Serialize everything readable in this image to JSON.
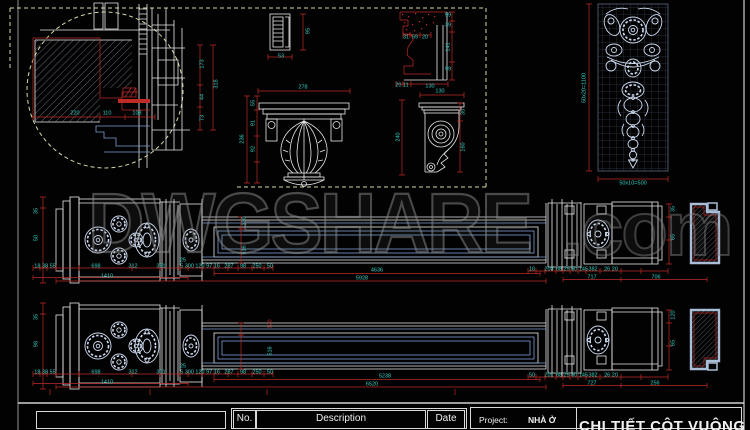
{
  "watermark": {
    "text": "DWGSHARE",
    "suffix": ".com"
  },
  "title_block": {
    "no": "No.",
    "description": "Description",
    "date": "Date",
    "project_label": "Project:",
    "project_value": "NHÀ Ở",
    "drawing_title": "CHI TIẾT CỘT VUÔNG"
  },
  "colors": {
    "background": "#020202",
    "line": "#e8e8e8",
    "blue": "#7d9fd4",
    "ornament": "#cfdcf2",
    "dim_line": "#bf2b26",
    "dim_text": "#35cfc4",
    "dashed": "#d8d8a8",
    "grid": "#46536a",
    "section": "#a9bdd6",
    "frame": "#cfcfcf"
  },
  "annotations": [
    {
      "t": "220",
      "x": 75,
      "y": 114
    },
    {
      "t": "110",
      "x": 107,
      "y": 114
    },
    {
      "t": "108",
      "x": 137,
      "y": 114
    },
    {
      "t": "173",
      "x": 203,
      "y": 64,
      "r": -90
    },
    {
      "t": "318",
      "x": 217,
      "y": 84,
      "r": -90
    },
    {
      "t": "44",
      "x": 203,
      "y": 97,
      "r": -90
    },
    {
      "t": "73",
      "x": 203,
      "y": 118,
      "r": -90
    },
    {
      "t": "95",
      "x": 309,
      "y": 31,
      "r": -90
    },
    {
      "t": "53",
      "x": 281,
      "y": 57
    },
    {
      "t": "99",
      "x": 448,
      "y": 16
    },
    {
      "t": "39",
      "x": 448,
      "y": 26
    },
    {
      "t": "141",
      "x": 449,
      "y": 47,
      "r": -90
    },
    {
      "t": "99",
      "x": 448,
      "y": 70
    },
    {
      "t": "31",
      "x": 406,
      "y": 38
    },
    {
      "t": "59",
      "x": 415,
      "y": 38
    },
    {
      "t": "20",
      "x": 425,
      "y": 38
    },
    {
      "t": "20 11",
      "x": 402,
      "y": 86
    },
    {
      "t": "130",
      "x": 430,
      "y": 87
    },
    {
      "t": "278",
      "x": 303,
      "y": 88
    },
    {
      "t": "236",
      "x": 243,
      "y": 139,
      "r": -90
    },
    {
      "t": "55",
      "x": 254,
      "y": 103,
      "r": -90
    },
    {
      "t": "91",
      "x": 254,
      "y": 123,
      "r": -90
    },
    {
      "t": "92",
      "x": 254,
      "y": 149,
      "r": -90
    },
    {
      "t": "240",
      "x": 399,
      "y": 137,
      "r": -90
    },
    {
      "t": "130",
      "x": 440,
      "y": 92
    },
    {
      "t": "35",
      "x": 464,
      "y": 112,
      "r": -90
    },
    {
      "t": "160",
      "x": 464,
      "y": 147,
      "r": -90
    },
    {
      "t": "50x20=1100",
      "x": 585,
      "y": 88,
      "r": -90
    },
    {
      "t": "50x10=500",
      "x": 633,
      "y": 184
    },
    {
      "t": "35",
      "x": 37,
      "y": 211,
      "r": -90
    },
    {
      "t": "50",
      "x": 37,
      "y": 238,
      "r": -90
    },
    {
      "t": "18 38 55",
      "x": 45,
      "y": 267
    },
    {
      "t": "698",
      "x": 96,
      "y": 267
    },
    {
      "t": "312",
      "x": 133,
      "y": 267
    },
    {
      "t": "381",
      "x": 161,
      "y": 267
    },
    {
      "t": "25",
      "x": 183,
      "y": 261
    },
    {
      "t": "5 300 120 97 16",
      "x": 200,
      "y": 267
    },
    {
      "t": "287",
      "x": 229,
      "y": 267
    },
    {
      "t": "98",
      "x": 243,
      "y": 267
    },
    {
      "t": "250",
      "x": 257,
      "y": 267
    },
    {
      "t": "50",
      "x": 270,
      "y": 267
    },
    {
      "t": "1410",
      "x": 107,
      "y": 277
    },
    {
      "t": "150",
      "x": 245,
      "y": 221,
      "r": -90
    },
    {
      "t": "516",
      "x": 245,
      "y": 250,
      "r": -90
    },
    {
      "t": "4636",
      "x": 377,
      "y": 271
    },
    {
      "t": "5928",
      "x": 362,
      "y": 279
    },
    {
      "t": "16",
      "x": 532,
      "y": 270
    },
    {
      "t": "203",
      "x": 549,
      "y": 270
    },
    {
      "t": "68 25 50 145",
      "x": 572,
      "y": 270
    },
    {
      "t": "382",
      "x": 593,
      "y": 270
    },
    {
      "t": "26 20",
      "x": 611,
      "y": 270
    },
    {
      "t": "717",
      "x": 592,
      "y": 278
    },
    {
      "t": "706",
      "x": 656,
      "y": 278
    },
    {
      "t": "35",
      "x": 674,
      "y": 209,
      "r": -90
    },
    {
      "t": "65",
      "x": 674,
      "y": 237,
      "r": -90
    },
    {
      "t": "35",
      "x": 37,
      "y": 317,
      "r": -90
    },
    {
      "t": "98",
      "x": 37,
      "y": 344,
      "r": -90
    },
    {
      "t": "18 38 55",
      "x": 45,
      "y": 373
    },
    {
      "t": "698",
      "x": 96,
      "y": 373
    },
    {
      "t": "312",
      "x": 133,
      "y": 373
    },
    {
      "t": "301",
      "x": 161,
      "y": 373
    },
    {
      "t": "25",
      "x": 183,
      "y": 367
    },
    {
      "t": "5 300 120 97 16",
      "x": 200,
      "y": 373
    },
    {
      "t": "287",
      "x": 229,
      "y": 373
    },
    {
      "t": "98",
      "x": 243,
      "y": 373
    },
    {
      "t": "250",
      "x": 257,
      "y": 373
    },
    {
      "t": "50",
      "x": 270,
      "y": 373
    },
    {
      "t": "1410",
      "x": 107,
      "y": 383
    },
    {
      "t": "120",
      "x": 271,
      "y": 324,
      "r": -90,
      "c": "red"
    },
    {
      "t": "516",
      "x": 271,
      "y": 351,
      "r": -90
    },
    {
      "t": "5238",
      "x": 385,
      "y": 377
    },
    {
      "t": "6520",
      "x": 372,
      "y": 385
    },
    {
      "t": "50",
      "x": 532,
      "y": 376
    },
    {
      "t": "201",
      "x": 549,
      "y": 376
    },
    {
      "t": "68 25 50 145",
      "x": 572,
      "y": 376
    },
    {
      "t": "382",
      "x": 593,
      "y": 376
    },
    {
      "t": "26 20",
      "x": 611,
      "y": 376
    },
    {
      "t": "727",
      "x": 592,
      "y": 384
    },
    {
      "t": "256",
      "x": 655,
      "y": 384
    },
    {
      "t": "120",
      "x": 674,
      "y": 315,
      "r": -90
    },
    {
      "t": "65",
      "x": 674,
      "y": 343,
      "r": -90
    }
  ]
}
